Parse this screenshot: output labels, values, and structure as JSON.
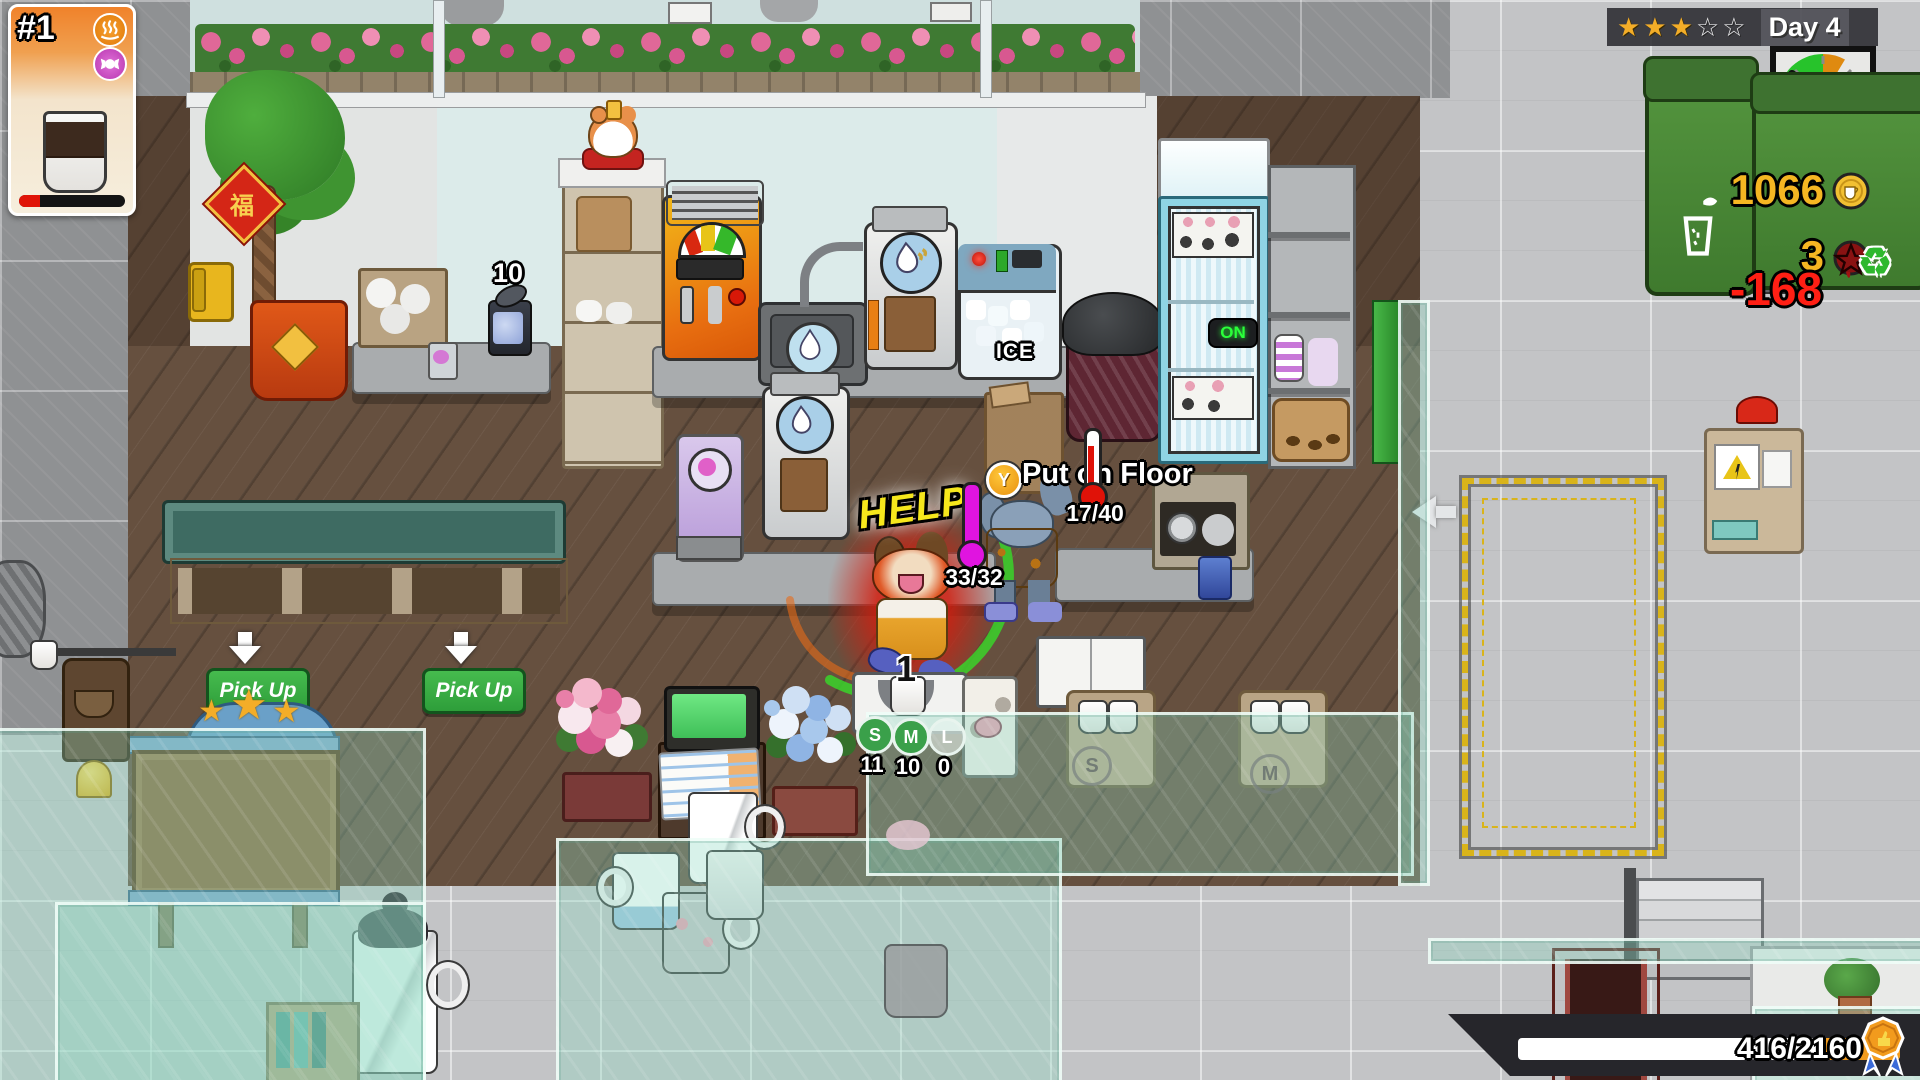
{
  "order_card": {
    "number": "#1",
    "progress_pct": 20,
    "temp_icon": "steam",
    "flavor_icon": "candy",
    "item": "coffee-cup"
  },
  "hud": {
    "stars_filled": "★★★",
    "stars_empty": "☆☆",
    "day": "Day 4",
    "money": "1066",
    "curse_count": "3",
    "expense": "-168",
    "goal": "416/2160"
  },
  "world": {
    "can_count": "10",
    "fridge_on": "ON",
    "help": "HELP",
    "temp_reading": "33/32",
    "prompt_button": "Y",
    "prompt_text": "Put on Floor",
    "capacity": "17/40",
    "queue_count": "1",
    "pickup_label": "Pick Up",
    "ice_label": "ICE",
    "fu_sign": "福",
    "sizes": [
      {
        "label": "S",
        "count": "11"
      },
      {
        "label": "M",
        "count": "10"
      },
      {
        "label": "L",
        "count": "0"
      }
    ],
    "room_badges": [
      "S",
      "M"
    ]
  },
  "colors": {
    "gold": "#f5b622",
    "expense_red": "#ff1f14",
    "pickup_green": "#35ab3f",
    "clock_green": "#27c32b",
    "clock_orange": "#df8a10",
    "glass_teal": "#8ed8c0"
  }
}
